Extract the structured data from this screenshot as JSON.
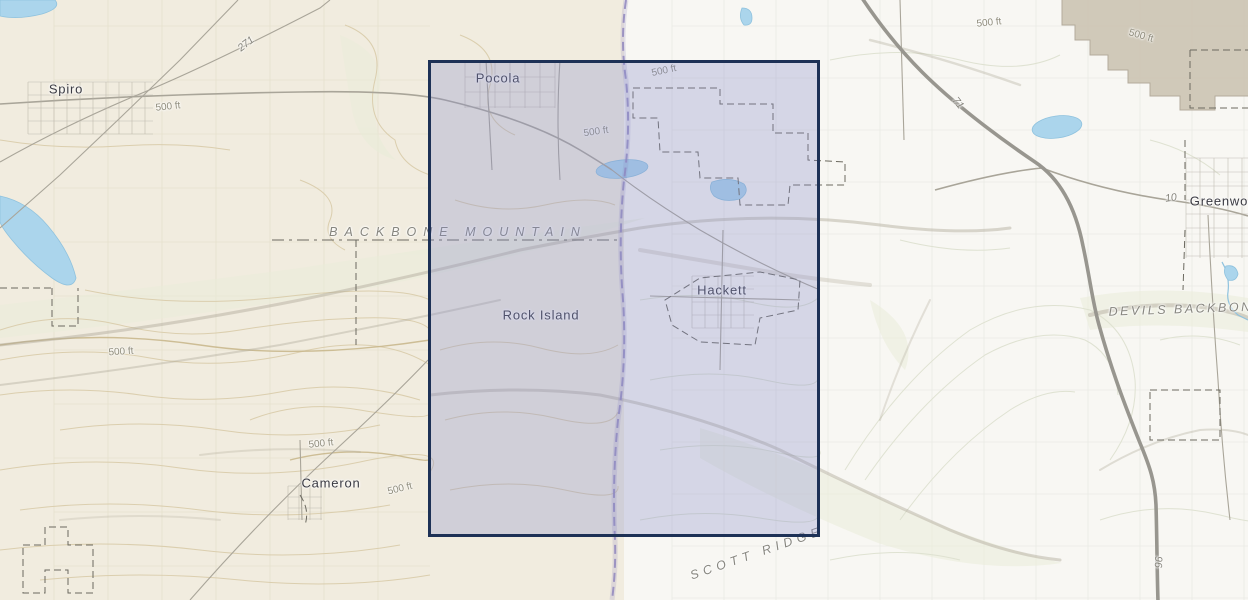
{
  "colors": {
    "left_bg": "#f1ecdf",
    "right_bg": "#f8f7f3",
    "urban_tint": "#cbc3b2",
    "contour_left": "#d8cba8",
    "contour_left_index": "#c9b88d",
    "contour_right": "#dde0d0",
    "ridge_shade": "#b0a999",
    "veg_tint": "#e9ecd8",
    "road": "#a9a599",
    "highway": "#98968f",
    "boundary_dash": "#6b695f",
    "water": "#abd5ec",
    "water_edge": "#8fc2de",
    "state_line": "#9187bd",
    "grid_left": "#e2dcc8",
    "grid_right": "#e6e6df",
    "selection_border": "#1d3156",
    "selection_fill": "rgba(134,140,202,0.30)"
  },
  "map": {
    "selection": {
      "x": 428,
      "y": 60,
      "width": 392,
      "height": 477
    },
    "labels": {
      "towns": [
        {
          "id": "spiro",
          "text": "Spiro",
          "x": 66,
          "y": 89
        },
        {
          "id": "pocola",
          "text": "Pocola",
          "x": 498,
          "y": 78
        },
        {
          "id": "rock-island",
          "text": "Rock Island",
          "x": 541,
          "y": 315
        },
        {
          "id": "hackett",
          "text": "Hackett",
          "x": 722,
          "y": 290
        },
        {
          "id": "cameron",
          "text": "Cameron",
          "x": 331,
          "y": 483
        },
        {
          "id": "greenwood",
          "text": "Greenwood",
          "x": 1227,
          "y": 201
        }
      ],
      "elevation": [
        {
          "id": "1",
          "text": "500 ft",
          "x": 168,
          "y": 107,
          "rot": -6
        },
        {
          "id": "2",
          "text": "500 ft",
          "x": 121,
          "y": 352,
          "rot": -4
        },
        {
          "id": "3",
          "text": "500 ft",
          "x": 321,
          "y": 444,
          "rot": -6
        },
        {
          "id": "4",
          "text": "500 ft",
          "x": 400,
          "y": 489,
          "rot": -14
        },
        {
          "id": "5",
          "text": "500 ft",
          "x": 596,
          "y": 132,
          "rot": -8
        },
        {
          "id": "6",
          "text": "500 ft",
          "x": 664,
          "y": 71,
          "rot": -12
        },
        {
          "id": "7",
          "text": "500 ft",
          "x": 989,
          "y": 23,
          "rot": -6
        },
        {
          "id": "8",
          "text": "500 ft",
          "x": 1141,
          "y": 36,
          "rot": 16
        }
      ],
      "routes": [
        {
          "id": "271",
          "text": "271",
          "x": 246,
          "y": 44,
          "rot": -38
        },
        {
          "id": "71",
          "text": "71",
          "x": 958,
          "y": 103,
          "rot": 52
        },
        {
          "id": "10",
          "text": "10",
          "x": 1171,
          "y": 198,
          "rot": -8
        },
        {
          "id": "96",
          "text": "96",
          "x": 1158,
          "y": 562,
          "rot": 92
        }
      ],
      "ridges": [
        {
          "id": "backbone-mountain",
          "text": "BACKBONE MOUNTAIN",
          "x": 458,
          "y": 232,
          "rot": 0,
          "ls": 7
        },
        {
          "id": "devils-backbone",
          "text": "DEVILS BACKBONE",
          "x": 1186,
          "y": 309,
          "rot": -2,
          "ls": 2.5
        },
        {
          "id": "scott-ridge",
          "text": "SCOTT RIDGE",
          "x": 757,
          "y": 553,
          "rot": -19,
          "ls": 5
        }
      ]
    }
  }
}
